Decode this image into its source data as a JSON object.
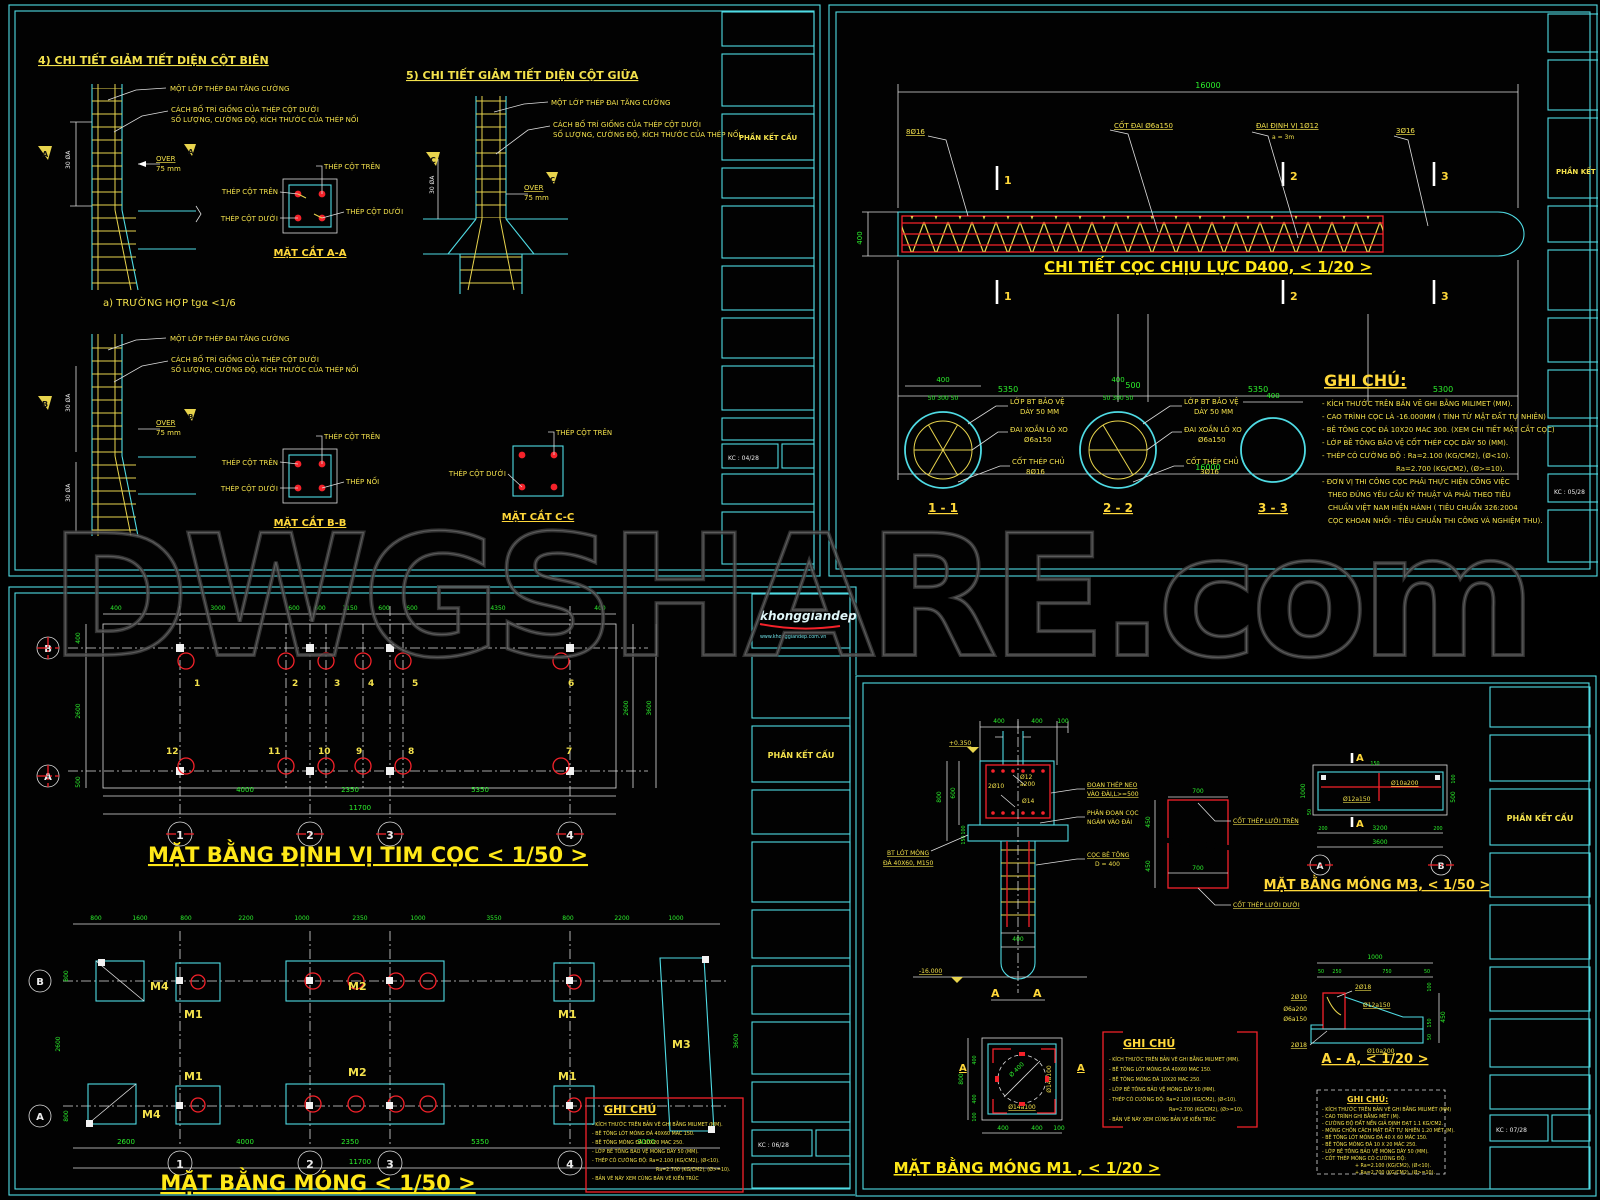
{
  "watermark": "DWGSHARE.com",
  "logo": {
    "name": "khonggiandep",
    "url": "www.khonggiandep.com.vn"
  },
  "title_block": {
    "label": "PHẦN KẾT CẤU",
    "sheet1_no": "KC : 04/28",
    "sheet2_no": "KC : 05/28",
    "sheet3_no": "KC : 06/28",
    "sheet4_no": "KC : 07/28"
  },
  "colors": {
    "frame": "#4fdbe4",
    "label": "#f3e14c",
    "dim": "#2cf02c",
    "accent": "#f5222a",
    "title": "#ffe818",
    "watermark": "#4a4a4a"
  },
  "sheet1": {
    "title_detail4": "4) CHI TIẾT GIẢM TIẾT DIỆN CỘT BIÊN",
    "title_detail5": "5) CHI TIẾT GIẢM TIẾT DIỆN CỘT GIỮA",
    "case_a": "a) TRƯỜNG HỢP tgα <1/6",
    "labels": {
      "mot_lop_thep_dai": "MỘT LỚP THÉP ĐAI TĂNG CƯỜNG",
      "cach_bo_tri": "CÁCH BỐ TRÍ GIỐNG CỦA THÉP CỘT DƯỚI",
      "so_luong": "SỐ LƯỢNG, CƯỜNG ĐỘ, KÍCH THƯỚC CỦA THÉP NỐI",
      "over": "OVER",
      "mm75": "75 mm",
      "thep_cot_tren": "THÉP CỘT TRÊN",
      "thep_cot_duoi": "THÉP CỘT DƯỚI",
      "thep_noi": "THÉP NỐI",
      "dim_30da": "30 ØA"
    },
    "captions": {
      "aa": "MẶT CẮT A-A",
      "bb": "MẶT CẮT B-B",
      "cc": "MẶT CẮT C-C"
    },
    "markers": {
      "a": "A",
      "b": "B",
      "c": "C"
    }
  },
  "sheet2": {
    "title": "CHI TIẾT CỌC CHỊU LỰC D400, < 1/20 >",
    "elevation": {
      "dim_total": "16000",
      "dim_height": "400",
      "dims_bottom": [
        "5350",
        "500",
        "5350",
        "5300"
      ],
      "label_8d16": "8Ø16",
      "label_cot_dai": "CỐT ĐAI Ø6a150",
      "label_dai_dinh_vi": "ĐAI ĐỊNH VỊ 1Ø12",
      "label_a3m": "a = 3m",
      "label_3d16": "3Ø16",
      "marks": [
        "1",
        "2",
        "3"
      ]
    },
    "sections": [
      {
        "name": "1 - 1",
        "dim_top": "400",
        "dim_sub": "50   300   50",
        "bv1": "LỚP BT BẢO VỆ",
        "bv2": "DÀY 50 MM",
        "dx1": "ĐAI XOẮN LÒ XO",
        "dx2": "Ø6a150",
        "ct1": "CỐT THÉP CHỦ",
        "ct2": "8Ø16"
      },
      {
        "name": "2 - 2",
        "dim_top": "400",
        "dim_sub": "50   300   50",
        "bv1": "LỚP BT BẢO VỆ",
        "bv2": "DÀY 50 MM",
        "dx1": "ĐAI XOẮN LÒ XO",
        "dx2": "Ø6a150",
        "ct1": "CỐT THÉP CHỦ",
        "ct2": "3Ø16"
      },
      {
        "name": "3 - 3",
        "dim_top": "400"
      }
    ],
    "notes": {
      "heading": "GHI CHÚ:",
      "lines": [
        "- KÍCH THƯỚC TRÊN BẢN VẼ GHI BẰNG MILIMET (MM).",
        "- CAO TRÌNH CỌC LÀ -16.000MM ( TÍNH TỪ MẶT ĐẤT TỰ NHIÊN)",
        "- BÊ TÔNG CỌC ĐÁ 10X20 MAC 300. (XEM CHI TIẾT MẶT CẮT CỌC)",
        "- LỚP BÊ TÔNG BẢO VỆ CỐT THÉP CỌC DÀY 50 (MM).",
        "- THÉP CÓ CƯỜNG ĐỘ : Ra=2.100 (KG/CM2), (Ø<10).",
        "Ra=2.700 (KG/CM2), (Ø>=10).",
        "- ĐƠN VỊ THI CÔNG CỌC PHẢI THỰC HIỆN CÔNG VIỆC",
        "THEO ĐÚNG YÊU CẦU KỸ THUẬT VÀ PHẢI THEO TIÊU",
        "CHUẨN VIỆT NAM HIỆN HÀNH ( TIÊU CHUẨN 326:2004",
        "CỌC KHOAN NHỒI - TIÊU CHUẨN THI CÔNG VÀ NGHIỆM THU)."
      ]
    }
  },
  "sheet3": {
    "plan1": {
      "title": "MẶT BẰNG ĐỊNH VỊ TIM CỌC < 1/50 >",
      "dims_top": [
        "400",
        "3000",
        "600",
        "600",
        "1150",
        "600",
        "600",
        "4350",
        "400"
      ],
      "dims_bottom": [
        "4000",
        "2350",
        "5350"
      ],
      "dim_total": "11700",
      "dims_left": [
        "400",
        "2600",
        "500"
      ],
      "dims_right": [
        "2600",
        "3600"
      ],
      "piles_top": [
        "1",
        "2",
        "3",
        "4",
        "5",
        "6"
      ],
      "piles_bottom": [
        "12",
        "11",
        "10",
        "9",
        "8",
        "7"
      ],
      "rows": [
        "B",
        "A"
      ],
      "cols": [
        "1",
        "2",
        "3",
        "4"
      ]
    },
    "plan2": {
      "title": "MẶT BẰNG MÓNG < 1/50 >",
      "dims_top": [
        "800",
        "1600",
        "800",
        "2200",
        "1000",
        "2350",
        "1000",
        "3550",
        "800",
        "2200",
        "1000"
      ],
      "dims_bottom": [
        "2600",
        "4000",
        "2350",
        "5350",
        "3000"
      ],
      "dim_total": "11700",
      "dims_side": [
        "800",
        "2600",
        "800"
      ],
      "footings": {
        "m1": "M1",
        "m2": "M2",
        "m3": "M3",
        "m4": "M4"
      }
    },
    "notes": {
      "heading": "GHI CHÚ",
      "lines": [
        "- KÍCH THƯỚC TRÊN BẢN VẼ GHI BẰNG MILIMET (MM).",
        "- BÊ TÔNG LÓT MÓNG ĐÁ 40X60  MAC 150.",
        "- BÊ TÔNG MÓNG ĐÁ 10X20 MAC 250.",
        "- LỚP BÊ TÔNG BẢO VỆ MÓNG DÀY 50 (MM).",
        "- THÉP CÓ CƯỜNG ĐỘ:  Ra=2.100 (KG/CM2), (Ø<10).",
        "Ra=2.700 (KG/CM2), (Ø>=10).",
        "- BẢN VẼ NÀY XEM CÙNG BẢN VẼ KIẾN TRÚC"
      ]
    }
  },
  "sheet4": {
    "m1_section": {
      "dims_top": [
        "400",
        "400",
        "100"
      ],
      "level_top": "+0.350",
      "level_bottom": "-16.000",
      "dim_800": "800",
      "dim_600": "600",
      "dim_100": "100",
      "dim_150": "150",
      "dim_pile": "400",
      "l_2d10": "2Ø10",
      "l_d12": "Ø12",
      "l_a200": "a200",
      "l_d14": "Ø14",
      "neo1": "ĐOẠN THÉP NEO",
      "neo2": "VÀO ĐÀI,L>=500",
      "phan1": "PHÂN ĐOẠN CỌC",
      "phan2": "NGÀM VÀO ĐÀI",
      "coc1": "CỌC BÊ TÔNG",
      "coc2": "D = 400",
      "lot1": "BT LÓT MÓNG",
      "lot2": "ĐÁ 40X60, M150",
      "mark": "A"
    },
    "grid_detail": {
      "dim_top": "700",
      "dim_mid": "700",
      "dim_450a": "450",
      "dim_450b": "450",
      "label_top": "CỐT THÉP LƯỚI TRÊN",
      "label_bottom": "CỐT THÉP LƯỚI DƯỚI"
    },
    "m3_plan": {
      "title": "MẶT BẰNG MÓNG M3, < 1/50 >",
      "l_d10a200": "Ø10a200",
      "l_d12a150": "Ø12a150",
      "dim_1000": "1000",
      "dim_50": "50",
      "dim_150": "150",
      "dim_100": "100",
      "dim_500": "500",
      "dims_bottom": [
        "200",
        "3200",
        "200"
      ],
      "dim_total": "3600",
      "axis_a": "A",
      "axis_b": "B",
      "mark": "A"
    },
    "aa_section": {
      "title": "A - A, < 1/20 >",
      "dim_1000": "1000",
      "dims_sub": [
        "50",
        "250",
        "750",
        "50"
      ],
      "dim_450": "450",
      "dims_right": [
        "100",
        "150",
        "50"
      ],
      "l_2d18_top": "2Ø18",
      "l_2d10": "2Ø10",
      "l_d6a200": "Ø6a200",
      "l_d6a150": "Ø6a150",
      "l_d12a150": "Ø12a150",
      "l_2d18_bot": "2Ø18",
      "l_d10a200": "Ø10a200"
    },
    "m1_plan": {
      "title": "MẶT BẰNG MÓNG M1 , < 1/20 >",
      "l_d14a100_v": "Ø14a100",
      "l_d14a100_b": "Ø14a100",
      "l_d400": "Ø 400",
      "dim_800": "800",
      "dims_left": [
        "400",
        "400",
        "100"
      ],
      "dims_bottom": [
        "400",
        "400",
        "100"
      ],
      "mark": "A"
    },
    "notes1": {
      "heading": "GHI CHÚ",
      "lines": [
        "- KÍCH THƯỚC TRÊN BẢN VẼ GHI BẰNG MILIMET (MM).",
        "- BÊ TÔNG LÓT MÓNG ĐÁ 40X60  MAC 150.",
        "- BÊ TÔNG MÓNG ĐÁ 10X20 MAC 250.",
        "- LỚP BÊ TÔNG BẢO VỆ MÓNG DÀY 50 (MM).",
        "- THÉP CÓ CƯỜNG ĐỘ:  Ra=2.100 (KG/CM2), (Ø<10).",
        "Ra=2.700 (KG/CM2), (Ø>=10).",
        "- BẢN VẼ NÀY XEM CÙNG BẢN VẼ KIẾN TRÚC"
      ]
    },
    "notes2": {
      "heading": "GHI CHÚ:",
      "lines": [
        "- KÍCH THƯỚC TRÊN BẢN VẼ GHI BẰNG MILIMÉT (MM)",
        "- CAO TRÌNH GHI BẰNG MÉT (M).",
        "- CƯỜNG ĐỘ ĐẤT NỀN GIẢ ĐỊNH ĐẠT 1.1 KG/CM2.",
        "- MÓNG CHÔN CÁCH MẶT ĐẤT TỰ NHIÊN 1.20 MÉT (M).",
        "- BÊ TÔNG LÓT MÓNG ĐÁ 40 X 60 MÁC 150.",
        "- BÊ TÔNG MÓNG ĐÁ 10 X 20 MÁC 250.",
        "- LỚP BÊ TÔNG BẢO VỆ MÓNG DÀY 50 (MM).",
        "- CỐT THÉP MÓNG CÓ CƯỜNG ĐỘ:",
        "+ Ra=2.100 (KG/CM2), (Ø<10).",
        "+ Ra=2.700 (KG/CM2), (Ø>=10)."
      ]
    }
  }
}
